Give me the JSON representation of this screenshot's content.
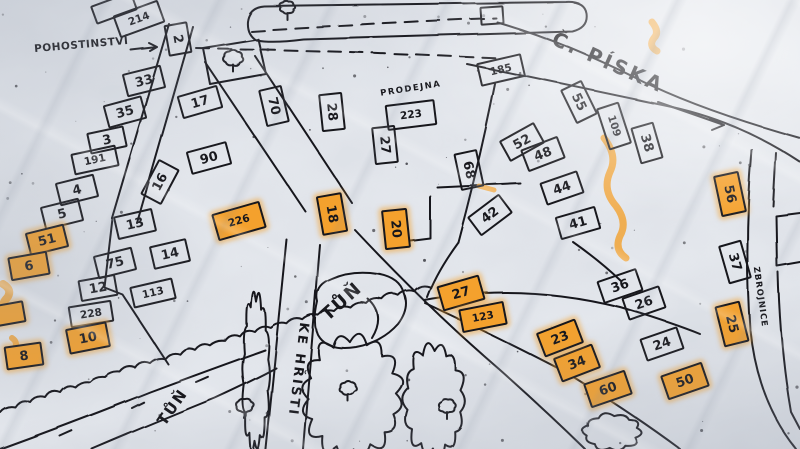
{
  "map": {
    "labels": {
      "pohostinstvi": "POHOSTINSTVÍ",
      "prodejna": "PRODEJNA",
      "piska": "Č. PÍSKA",
      "pond": "TŮŇ",
      "stream": "TŮŇ",
      "ke_hristi": "KE HŘIŠTI",
      "zbrojnice": "ZBROJNICE"
    },
    "colors": {
      "paper": "#e9ecf1",
      "ink": "#17171c",
      "highlight": "#f4a12d"
    },
    "houses": [
      {
        "n": "",
        "x": 112,
        "y": 6,
        "w": 40,
        "h": 16,
        "r": -20,
        "o": false
      },
      {
        "n": "214",
        "x": 137,
        "y": 17,
        "w": 44,
        "h": 20,
        "r": -20,
        "o": false
      },
      {
        "n": "2",
        "x": 176,
        "y": 37,
        "w": 28,
        "h": 20,
        "r": 80,
        "o": false
      },
      {
        "n": "33",
        "x": 142,
        "y": 79,
        "w": 36,
        "h": 20,
        "r": -14,
        "o": false
      },
      {
        "n": "35",
        "x": 123,
        "y": 110,
        "w": 36,
        "h": 20,
        "r": -15,
        "o": false
      },
      {
        "n": "3",
        "x": 105,
        "y": 138,
        "w": 34,
        "h": 18,
        "r": -12,
        "o": false
      },
      {
        "n": "191",
        "x": 93,
        "y": 158,
        "w": 42,
        "h": 18,
        "r": -12,
        "o": false
      },
      {
        "n": "4",
        "x": 75,
        "y": 188,
        "w": 36,
        "h": 20,
        "r": -14,
        "o": false
      },
      {
        "n": "5",
        "x": 60,
        "y": 212,
        "w": 36,
        "h": 20,
        "r": -14,
        "o": false
      },
      {
        "n": "51",
        "x": 45,
        "y": 238,
        "w": 36,
        "h": 20,
        "r": -14,
        "o": true
      },
      {
        "n": "6",
        "x": 27,
        "y": 264,
        "w": 36,
        "h": 20,
        "r": -10,
        "o": true
      },
      {
        "n": "",
        "x": 6,
        "y": 312,
        "w": 30,
        "h": 18,
        "r": -10,
        "o": true
      },
      {
        "n": "8",
        "x": 22,
        "y": 354,
        "w": 34,
        "h": 20,
        "r": -8,
        "o": true
      },
      {
        "n": "17",
        "x": 198,
        "y": 100,
        "w": 38,
        "h": 20,
        "r": -16,
        "o": false
      },
      {
        "n": "70",
        "x": 272,
        "y": 104,
        "w": 34,
        "h": 20,
        "r": 77,
        "o": false
      },
      {
        "n": "90",
        "x": 207,
        "y": 156,
        "w": 38,
        "h": 20,
        "r": -15,
        "o": false
      },
      {
        "n": "16",
        "x": 158,
        "y": 180,
        "w": 36,
        "h": 20,
        "r": -62,
        "o": false
      },
      {
        "n": "13",
        "x": 133,
        "y": 222,
        "w": 36,
        "h": 20,
        "r": -13,
        "o": false
      },
      {
        "n": "14",
        "x": 168,
        "y": 252,
        "w": 34,
        "h": 20,
        "r": -13,
        "o": false
      },
      {
        "n": "75",
        "x": 113,
        "y": 261,
        "w": 36,
        "h": 20,
        "r": -14,
        "o": false
      },
      {
        "n": "12",
        "x": 96,
        "y": 286,
        "w": 34,
        "h": 18,
        "r": -10,
        "o": false
      },
      {
        "n": "113",
        "x": 151,
        "y": 291,
        "w": 40,
        "h": 18,
        "r": -13,
        "o": false
      },
      {
        "n": "228",
        "x": 89,
        "y": 312,
        "w": 40,
        "h": 18,
        "r": -9,
        "o": false
      },
      {
        "n": "10",
        "x": 86,
        "y": 336,
        "w": 38,
        "h": 22,
        "r": -11,
        "o": true
      },
      {
        "n": "226",
        "x": 237,
        "y": 219,
        "w": 46,
        "h": 24,
        "r": -16,
        "o": true
      },
      {
        "n": "28",
        "x": 330,
        "y": 110,
        "w": 34,
        "h": 20,
        "r": 84,
        "o": false
      },
      {
        "n": "27",
        "x": 383,
        "y": 143,
        "w": 34,
        "h": 20,
        "r": 84,
        "o": false
      },
      {
        "n": "223",
        "x": 409,
        "y": 113,
        "w": 46,
        "h": 22,
        "r": -7,
        "o": false
      },
      {
        "n": "18",
        "x": 330,
        "y": 212,
        "w": 36,
        "h": 22,
        "r": 80,
        "o": true
      },
      {
        "n": "20",
        "x": 394,
        "y": 227,
        "w": 36,
        "h": 22,
        "r": 84,
        "o": true
      },
      {
        "n": "68",
        "x": 467,
        "y": 168,
        "w": 34,
        "h": 20,
        "r": 78,
        "o": false
      },
      {
        "n": "42",
        "x": 488,
        "y": 213,
        "w": 36,
        "h": 20,
        "r": -37,
        "o": false
      },
      {
        "n": "185",
        "x": 499,
        "y": 68,
        "w": 42,
        "h": 20,
        "r": -13,
        "o": false
      },
      {
        "n": "52",
        "x": 520,
        "y": 140,
        "w": 36,
        "h": 20,
        "r": -29,
        "o": false
      },
      {
        "n": "48",
        "x": 541,
        "y": 152,
        "w": 36,
        "h": 20,
        "r": -21,
        "o": false
      },
      {
        "n": "44",
        "x": 560,
        "y": 186,
        "w": 36,
        "h": 20,
        "r": -19,
        "o": false
      },
      {
        "n": "41",
        "x": 576,
        "y": 221,
        "w": 38,
        "h": 20,
        "r": -16,
        "o": false
      },
      {
        "n": "36",
        "x": 618,
        "y": 284,
        "w": 38,
        "h": 20,
        "r": -19,
        "o": false
      },
      {
        "n": "26",
        "x": 642,
        "y": 301,
        "w": 36,
        "h": 20,
        "r": -19,
        "o": false
      },
      {
        "n": "24",
        "x": 660,
        "y": 342,
        "w": 36,
        "h": 20,
        "r": -19,
        "o": false
      },
      {
        "n": "55",
        "x": 577,
        "y": 100,
        "w": 34,
        "h": 20,
        "r": 64,
        "o": false
      },
      {
        "n": "109",
        "x": 612,
        "y": 124,
        "w": 40,
        "h": 20,
        "r": 72,
        "o": false
      },
      {
        "n": "38",
        "x": 645,
        "y": 141,
        "w": 34,
        "h": 20,
        "r": 74,
        "o": false
      },
      {
        "n": "56",
        "x": 728,
        "y": 192,
        "w": 38,
        "h": 22,
        "r": 78,
        "o": true
      },
      {
        "n": "37",
        "x": 733,
        "y": 260,
        "w": 36,
        "h": 20,
        "r": 74,
        "o": false
      },
      {
        "n": "25",
        "x": 730,
        "y": 322,
        "w": 38,
        "h": 22,
        "r": 76,
        "o": true
      },
      {
        "n": "50",
        "x": 683,
        "y": 379,
        "w": 40,
        "h": 22,
        "r": -19,
        "o": true
      },
      {
        "n": "60",
        "x": 606,
        "y": 387,
        "w": 40,
        "h": 22,
        "r": -19,
        "o": true
      },
      {
        "n": "34",
        "x": 575,
        "y": 361,
        "w": 38,
        "h": 22,
        "r": -21,
        "o": true
      },
      {
        "n": "23",
        "x": 558,
        "y": 336,
        "w": 38,
        "h": 22,
        "r": -21,
        "o": true
      },
      {
        "n": "27",
        "x": 459,
        "y": 291,
        "w": 40,
        "h": 22,
        "r": -16,
        "o": true
      },
      {
        "n": "123",
        "x": 481,
        "y": 315,
        "w": 42,
        "h": 20,
        "r": -11,
        "o": true
      },
      {
        "n": "",
        "x": 490,
        "y": 13,
        "w": 20,
        "h": 15,
        "r": -4,
        "o": false
      }
    ],
    "trees": [
      {
        "x": 233,
        "y": 60,
        "r": 9
      },
      {
        "x": 287,
        "y": 9,
        "r": 7
      },
      {
        "x": 245,
        "y": 408,
        "r": 8
      },
      {
        "x": 348,
        "y": 390,
        "r": 8
      },
      {
        "x": 447,
        "y": 408,
        "r": 8
      }
    ]
  }
}
